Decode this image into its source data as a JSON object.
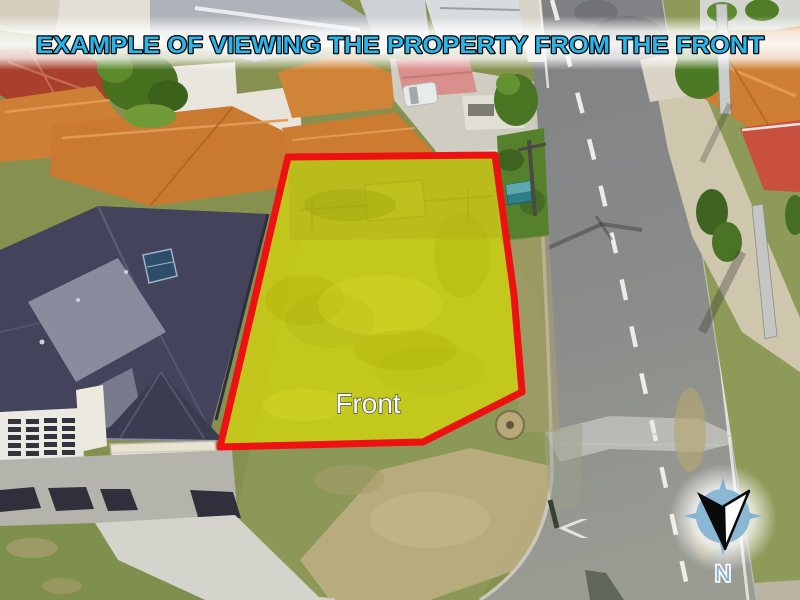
{
  "banner": {
    "title": "EXAMPLE OF VIEWING THE PROPERTY FROM THE FRONT",
    "text_color": "#2ab4e8",
    "outline_color": "#000000",
    "band_color": "#ffffff"
  },
  "parcel": {
    "label": "Front",
    "label_color": "#ffffff",
    "outline_color": "#ee1111",
    "highlight_color": "#d8d800"
  },
  "compass": {
    "label": "N",
    "rose_color": "#8ab7d4",
    "label_color": "#7fb0cf",
    "arrow_left_color": "#000000",
    "arrow_right_color": "#ffffff"
  }
}
